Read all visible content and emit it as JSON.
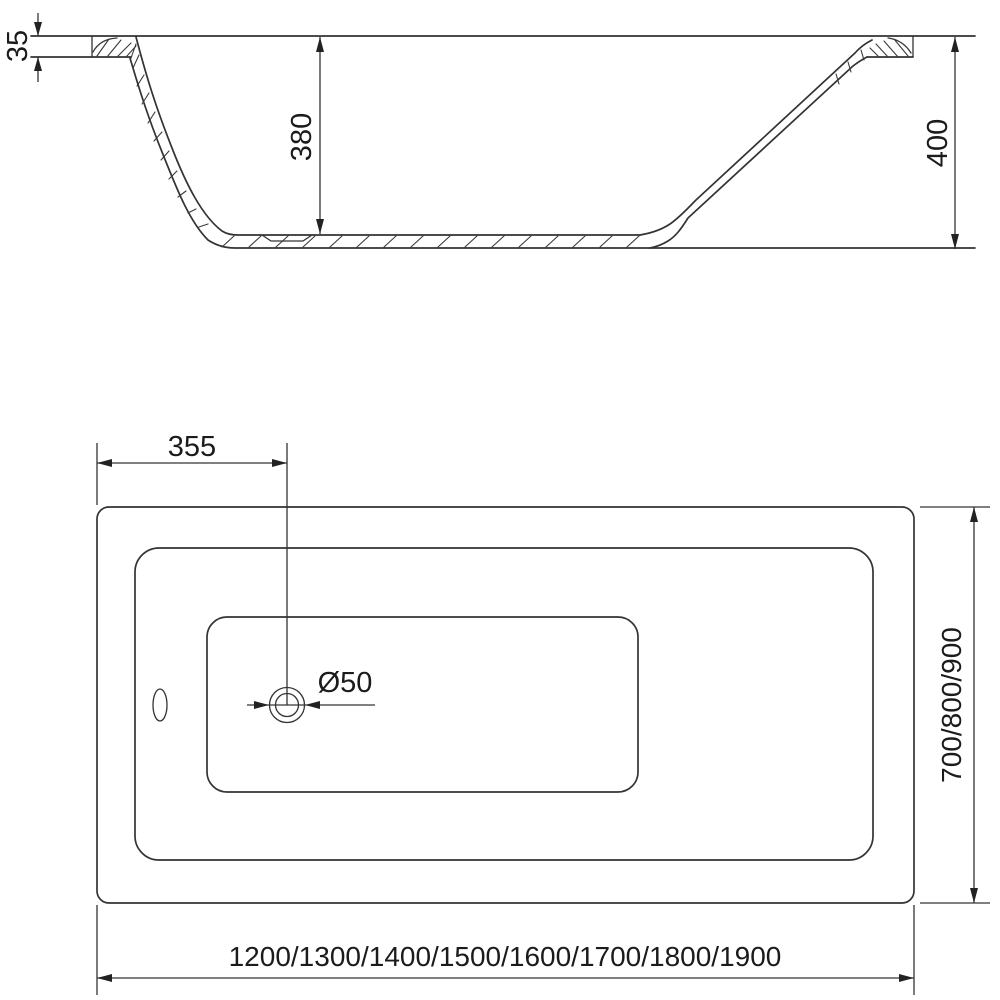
{
  "drawing": {
    "title": "bathtub-technical-drawing",
    "background_color": "#ffffff",
    "line_color": "#333333",
    "text_color": "#1b1b1b"
  },
  "cross_section_view": {
    "rim_thickness": "35",
    "inner_depth": "380",
    "total_height": "400"
  },
  "plan_view": {
    "drain_offset_from_edge": "355",
    "drain_diameter": "Ø50",
    "width_options": "700/800/900",
    "length_options": "1200/1300/1400/1500/1600/1700/1800/1900"
  }
}
